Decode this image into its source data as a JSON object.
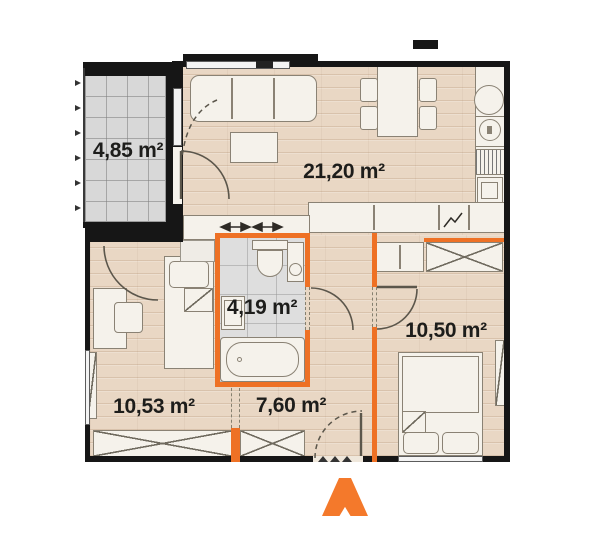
{
  "floor_plan": {
    "rooms": [
      {
        "id": "balcony",
        "area": "4,85 m²"
      },
      {
        "id": "living-room-kitchen",
        "area": "21,20 m²"
      },
      {
        "id": "bathroom",
        "area": "4,19 m²"
      },
      {
        "id": "bedroom-right",
        "area": "10,50 m²"
      },
      {
        "id": "bedroom-left",
        "area": "10,53 m²"
      },
      {
        "id": "hallway",
        "area": "7,60 m²"
      }
    ],
    "colors": {
      "accent_orange": "#EE7125",
      "entrance_arrow": "#F4792B",
      "wall": "#161616",
      "wood_floor": "#E9D7C4",
      "balcony_tile": "#D8D8D8",
      "bathroom_tile": "#DEDEDE",
      "furniture": "#F5F2EB",
      "label_text": "#1D1D1B"
    }
  }
}
